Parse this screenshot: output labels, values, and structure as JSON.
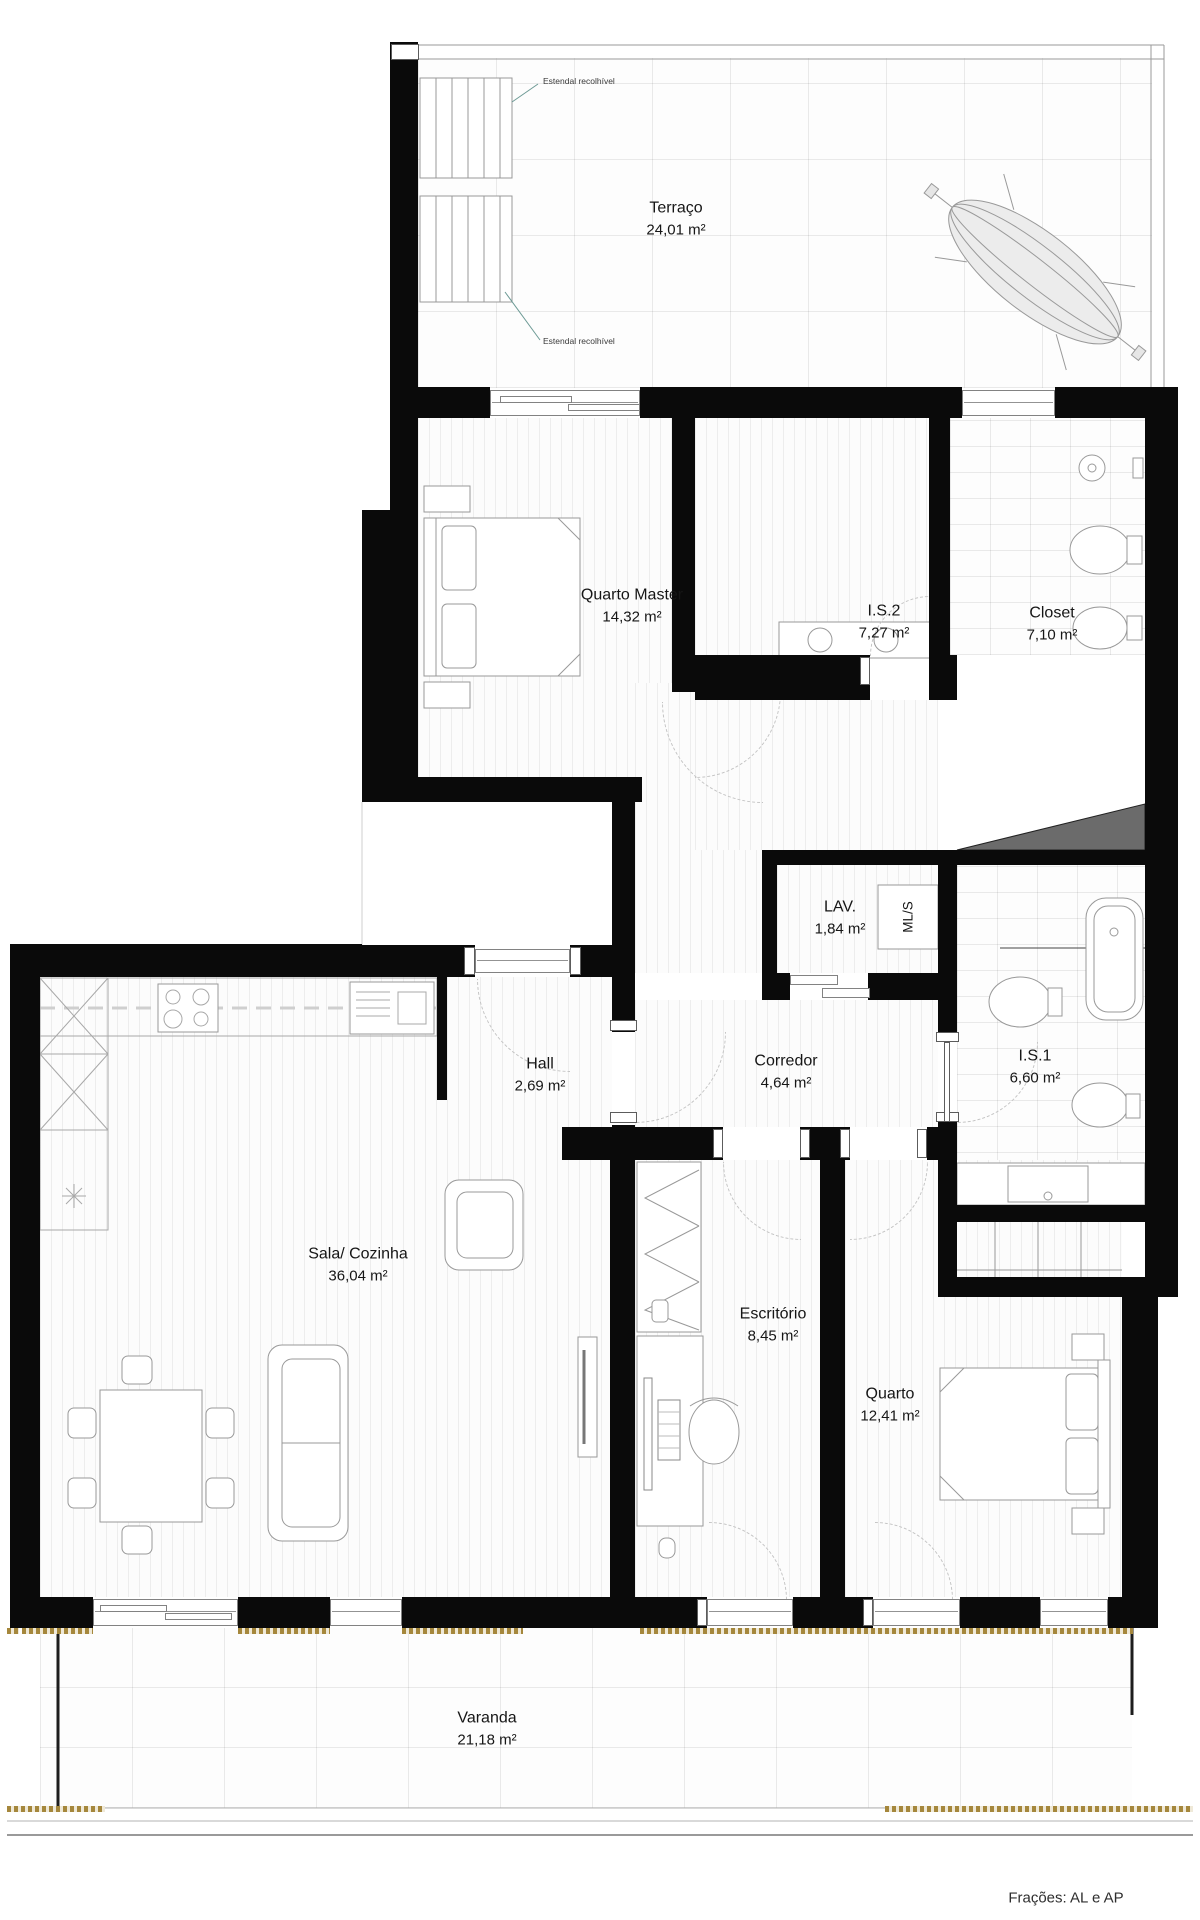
{
  "plan": {
    "rooms": {
      "terraco": {
        "name": "Terraço",
        "area": "24,01 m²"
      },
      "quarto_master": {
        "name": "Quarto Master",
        "area": "14,32 m²"
      },
      "is2": {
        "name": "I.S.2",
        "area": "7,27 m²"
      },
      "closet": {
        "name": "Closet",
        "area": "7,10 m²"
      },
      "lav": {
        "name": "LAV.",
        "area": "1,84 m²"
      },
      "mls": {
        "name": "ML/S"
      },
      "hall": {
        "name": "Hall",
        "area": "2,69 m²"
      },
      "corredor": {
        "name": "Corredor",
        "area": "4,64 m²"
      },
      "is1": {
        "name": "I.S.1",
        "area": "6,60 m²"
      },
      "sala": {
        "name": "Sala/ Cozinha",
        "area": "36,04 m²"
      },
      "escritorio": {
        "name": "Escritório",
        "area": "8,45 m²"
      },
      "quarto": {
        "name": "Quarto",
        "area": "12,41 m²"
      },
      "varanda": {
        "name": "Varanda",
        "area": "21,18 m²"
      }
    },
    "annotations": {
      "estendal_top": "Estendal recolhível",
      "estendal_bottom": "Estendal recolhível",
      "fracoes": "Frações: AL e AP"
    },
    "colors": {
      "wall": "#0a0a0a",
      "threshold_gold": "#a5873c",
      "duct_wedge": "#6b6b6b"
    }
  }
}
